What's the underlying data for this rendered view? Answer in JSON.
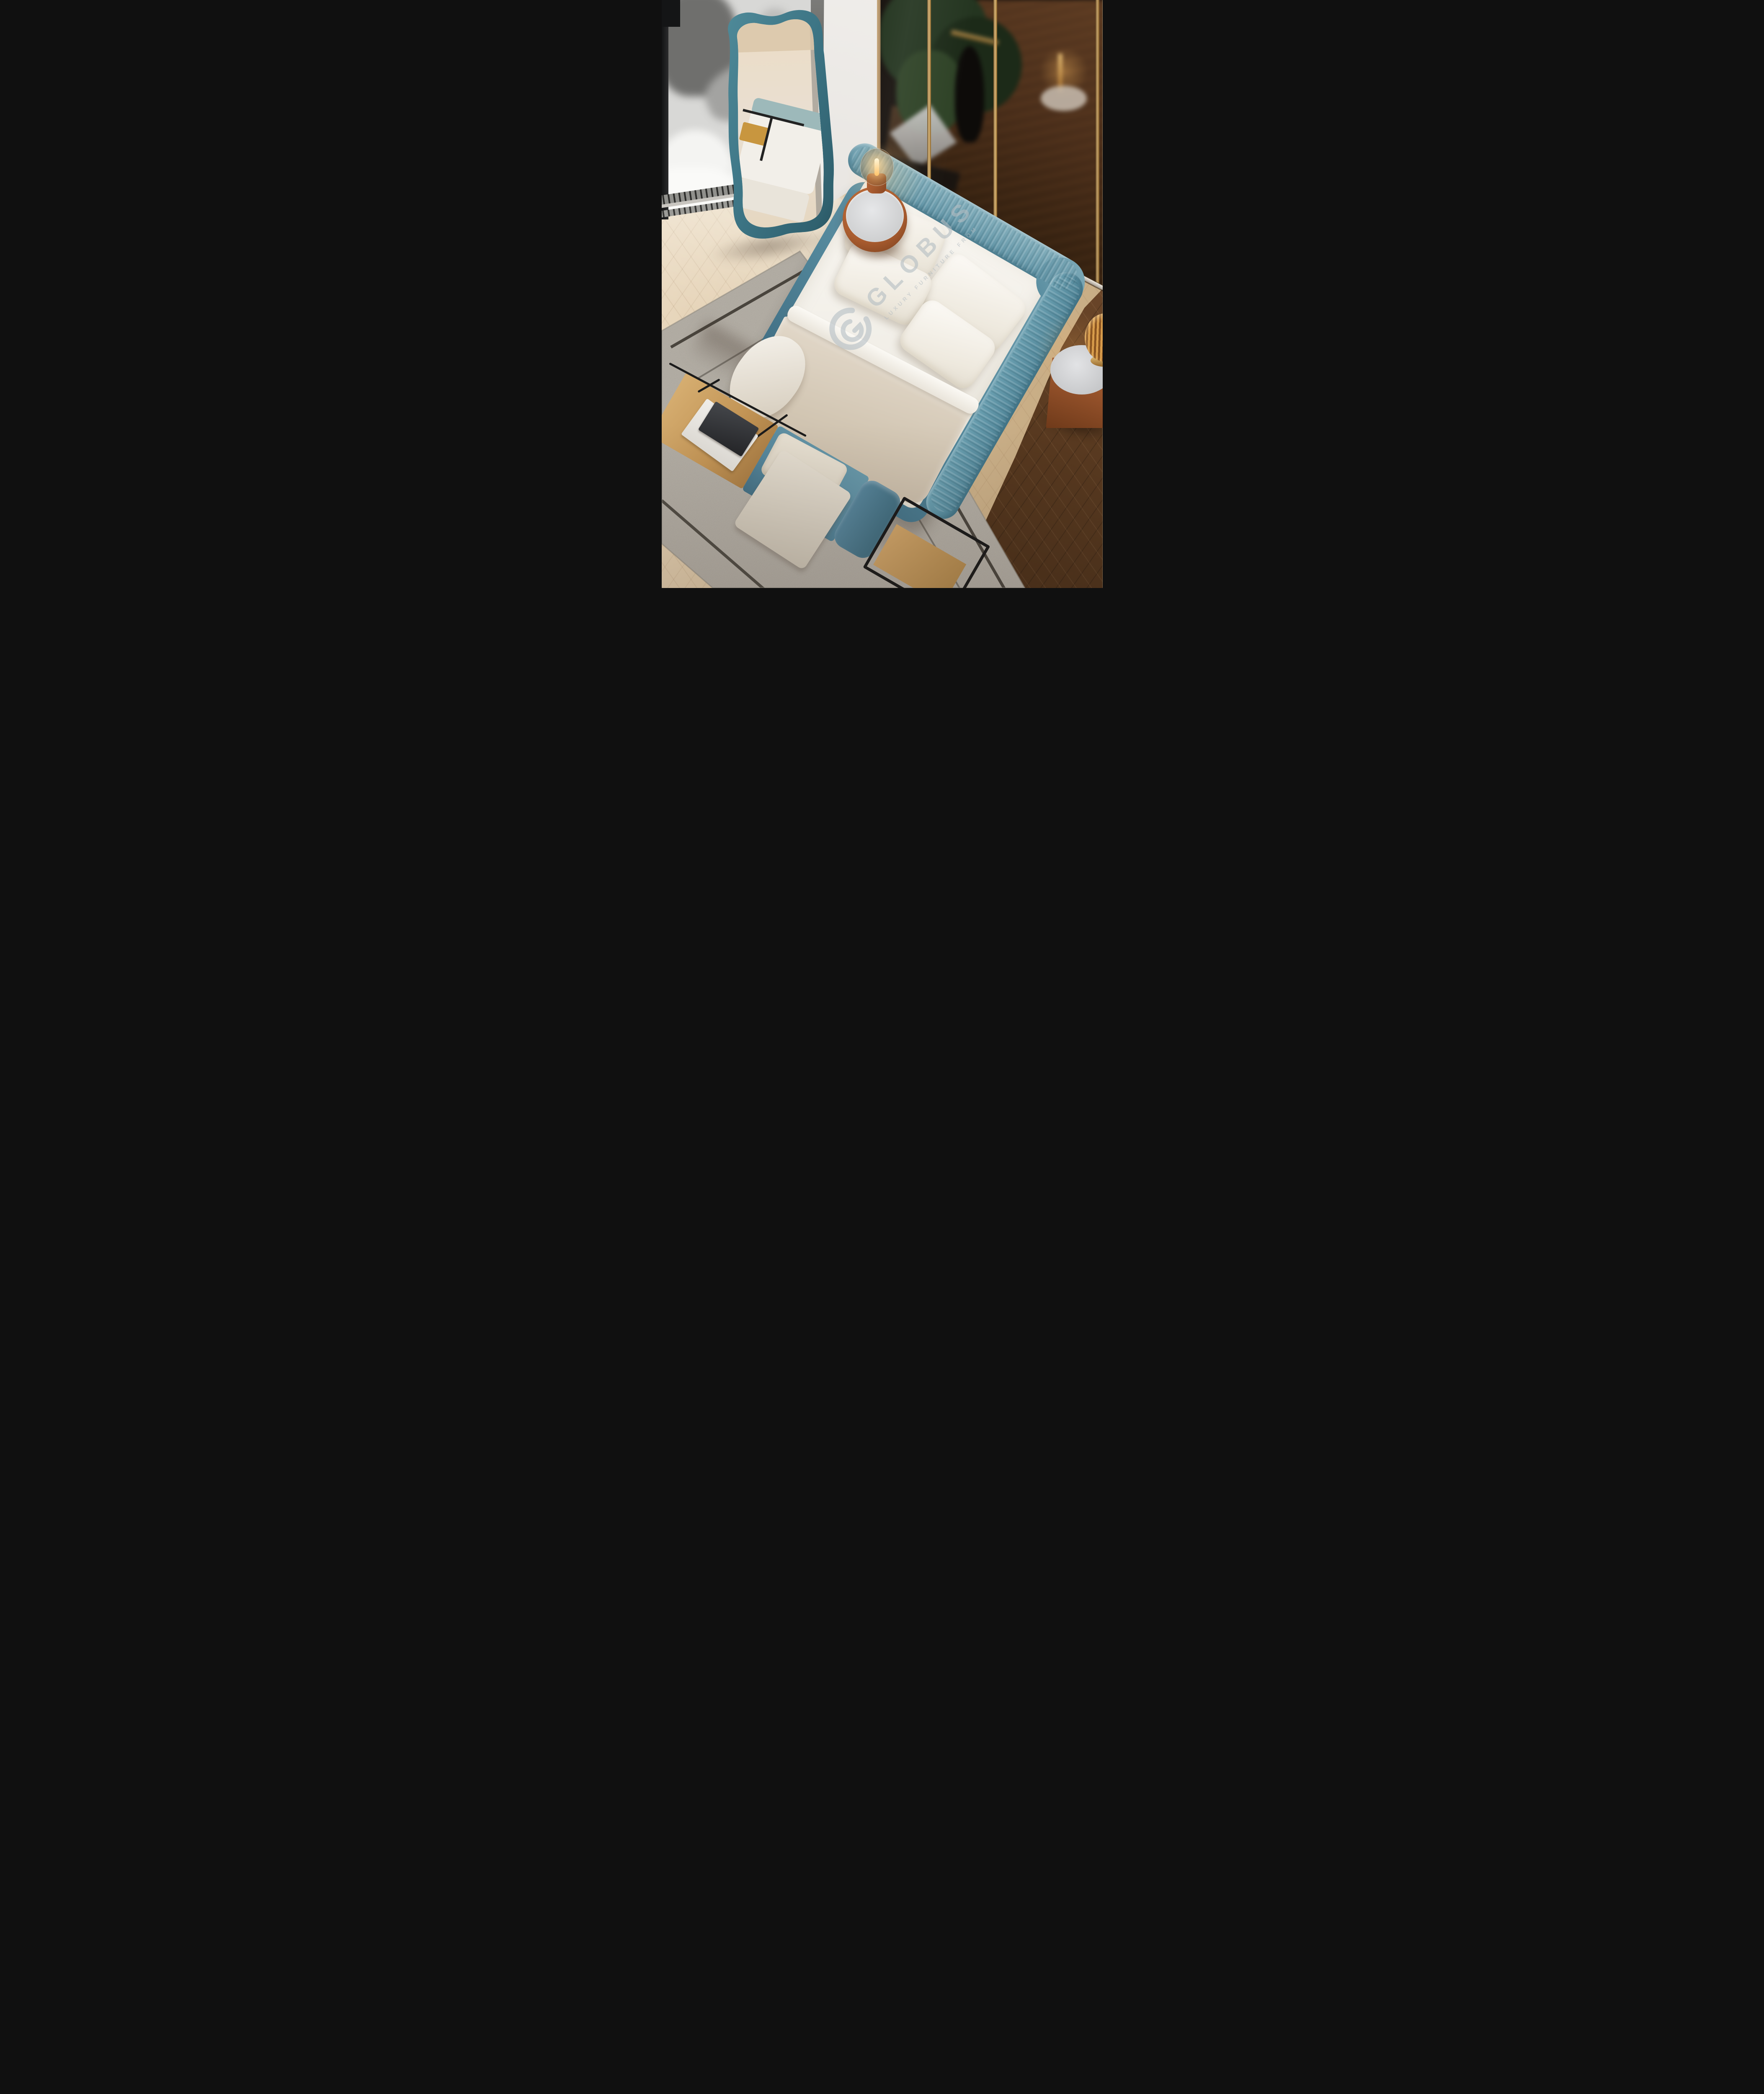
{
  "image": {
    "type": "furniture-showroom-render",
    "room": "bedroom",
    "view": "high-angle top-down view of a modern bedroom with a teal upholstered bed"
  },
  "watermark": {
    "logo": "globus-g-ring-logo",
    "brand": "GLOBUS",
    "tagline": "LUXURY FURNITURE FROM"
  },
  "palette": {
    "bed_teal": "#5f93a5",
    "bed_teal_dark": "#3e6b80",
    "mirror_teal": "#447d8b",
    "terracotta": "#ad6134",
    "marble_top": "#d9dadc",
    "bedding_white": "#f3f0ea",
    "blanket_beige": "#d5cab8",
    "rug_gray": "#b8b3aa",
    "rug_stripe": "#37332c",
    "floor_light_oak": "#dcc6a5",
    "floor_dark_walnut": "#55371e",
    "partition_glass": "#17120e",
    "wardrobe_wood": "#4a2e1a",
    "brass": "#d9b678",
    "lamp_glow": "#ffc46a",
    "wall_white": "#edeae6",
    "window_grayscale": "#d8d8d6",
    "bench_wood_oak": "#c29455",
    "metal_frame_black": "#191919"
  },
  "scene": {
    "objects": [
      {
        "name": "bed",
        "description": "double bed with curved wraparound pleated headboard",
        "color": "#5f93a5"
      },
      {
        "name": "pillows",
        "description": "four white pillows against headboard",
        "count": 4,
        "color": "#f3f0ea"
      },
      {
        "name": "blanket",
        "description": "beige throw blanket across lower half of mattress",
        "color": "#d5cab8"
      },
      {
        "name": "floor-mirror",
        "description": "wavy organic-frame leaning floor mirror reflecting bed and bench",
        "color": "#447d8b"
      },
      {
        "name": "nightstand-left",
        "description": "cylindrical terracotta leather nightstand with marble top and glass-dome bulb lamp",
        "color": "#ad6134"
      },
      {
        "name": "nightstand-right",
        "description": "tapered terracotta drum nightstand with marble top and ribbed amber glass lamp",
        "color": "#ad6134"
      },
      {
        "name": "bench",
        "description": "foot bench with oak shelf ends, black metal frame, teal seat, cream cushion, draped blanket and two books",
        "color": "#54859a"
      },
      {
        "name": "rug",
        "description": "light gray boucle rug with dark inset border stripes",
        "color": "#b8b3aa"
      },
      {
        "name": "glass-partition",
        "description": "smoked glass and dark wood wardrobe partition with brass trim, plant and lamp reflections",
        "color": "#17120e"
      },
      {
        "name": "window",
        "description": "blurred grayscale view outside window with floor vent grille",
        "color": "#d8d8d6"
      },
      {
        "name": "floor",
        "description": "chevron parquet, sunlit pale oak near window fading to dark walnut at right",
        "color": "#dcc6a5"
      }
    ]
  }
}
